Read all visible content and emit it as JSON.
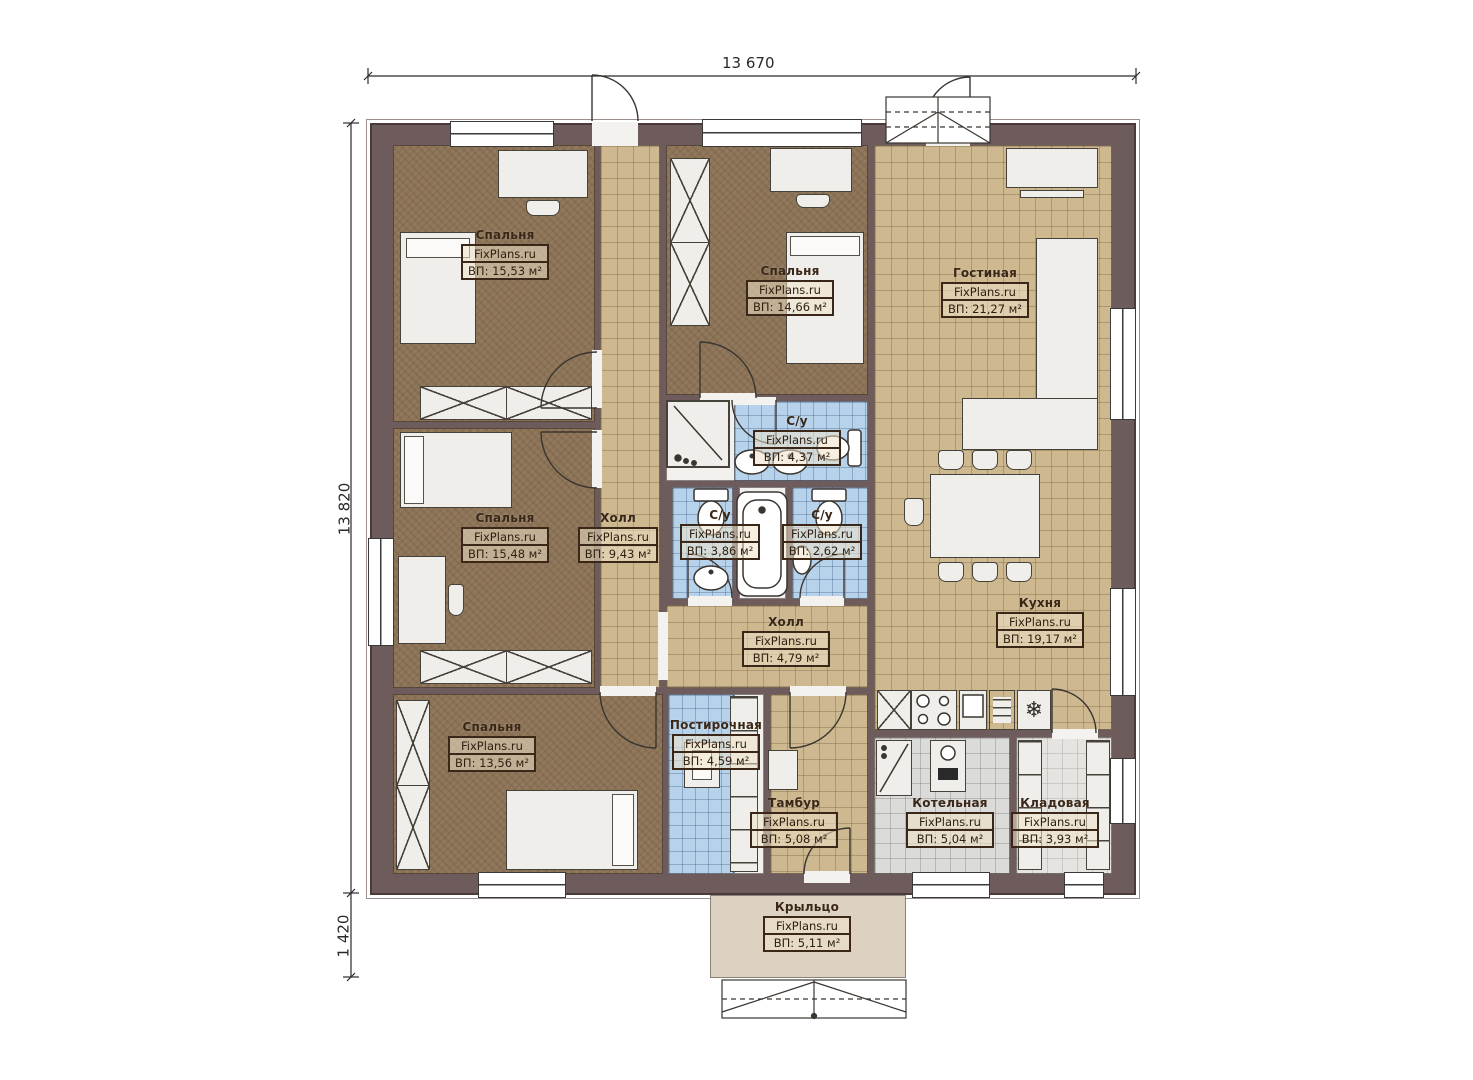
{
  "watermark": "FixPlans.ru",
  "dims": {
    "top": "13 670",
    "left": "13 820",
    "left_bottom": "1 420"
  },
  "rooms": [
    {
      "id": "bedroom-1",
      "name": "Спальня",
      "area": "ВП: 15,53 м²"
    },
    {
      "id": "bedroom-2",
      "name": "Спальня",
      "area": "ВП: 15,48 м²"
    },
    {
      "id": "bedroom-3",
      "name": "Спальня",
      "area": "ВП: 13,56 м²"
    },
    {
      "id": "bedroom-4",
      "name": "Спальня",
      "area": "ВП: 14,66 м²"
    },
    {
      "id": "living",
      "name": "Гостиная",
      "area": "ВП: 21,27 м²"
    },
    {
      "id": "hall-main",
      "name": "Холл",
      "area": "ВП: 9,43 м²"
    },
    {
      "id": "bath-1",
      "name": "С/у",
      "area": "ВП: 4,37 м²"
    },
    {
      "id": "bath-2",
      "name": "С/у",
      "area": "ВП: 3,86 м²"
    },
    {
      "id": "bath-3",
      "name": "С/у",
      "area": "ВП: 2,62 м²"
    },
    {
      "id": "hall-2",
      "name": "Холл",
      "area": "ВП: 4,79 м²"
    },
    {
      "id": "kitchen",
      "name": "Кухня",
      "area": "ВП: 19,17 м²"
    },
    {
      "id": "laundry",
      "name": "Постирочная",
      "area": "ВП: 4,59 м²"
    },
    {
      "id": "tambour",
      "name": "Тамбур",
      "area": "ВП: 5,08 м²"
    },
    {
      "id": "boiler",
      "name": "Котельная",
      "area": "ВП: 5,04 м²"
    },
    {
      "id": "storage",
      "name": "Кладовая",
      "area": "ВП: 3,93 м²"
    },
    {
      "id": "porch",
      "name": "Крыльцо",
      "area": "ВП: 5,11 м²"
    }
  ],
  "colors": {
    "wall": "#6e5b5b",
    "bedroom_floor": "#8c7356",
    "tile_beige": "#cdb88f",
    "tile_blue": "#b7d3eb",
    "tile_gray": "#dbdbd9",
    "porch": "#ddd2c1",
    "furniture": "#efeeea",
    "label_ink": "#3a2717"
  }
}
